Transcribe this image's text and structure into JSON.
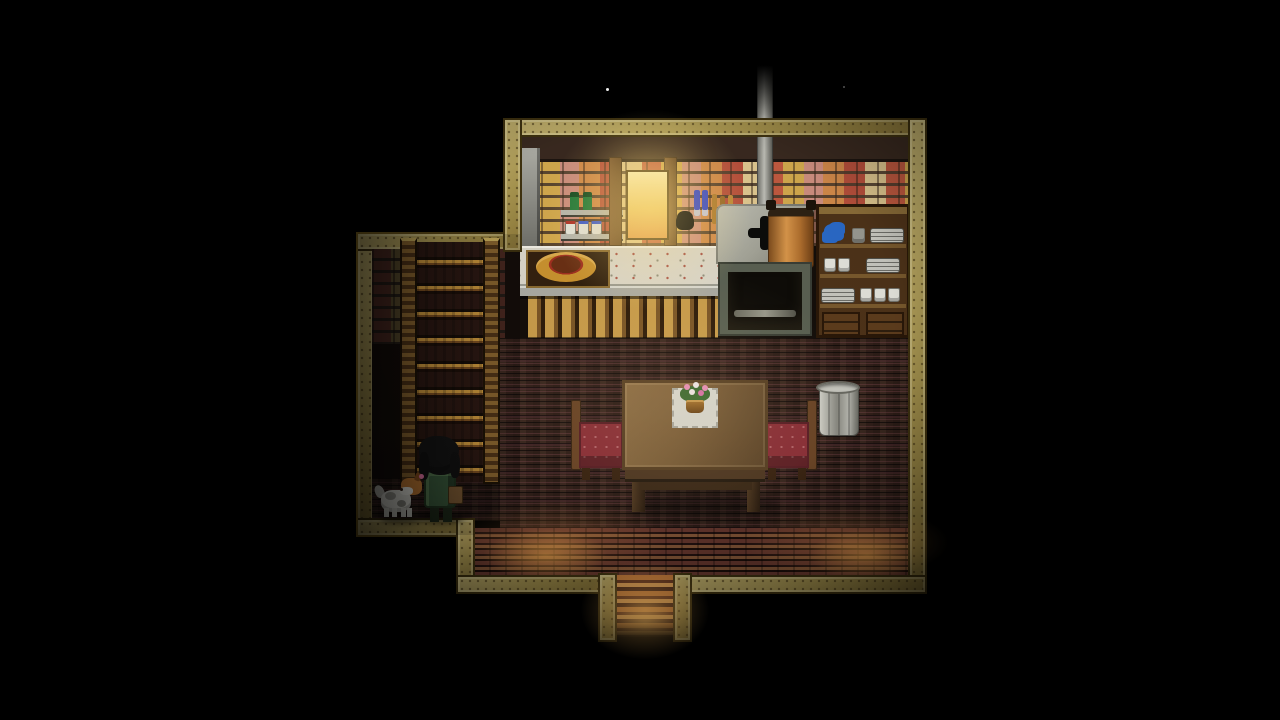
{
  "meta": {
    "app": "pixel-rpg",
    "scene_label": "Top-down pixel-art cottage interior at night",
    "view": "top-down"
  },
  "palette": {
    "frame_light": "#c9b873",
    "frame_mid": "#a8954f",
    "frame_dark": "#403310",
    "wall_band": "#3a2a20",
    "wall_dark_bg": "#140e0a",
    "mortar": "#6e5b47",
    "brick_a": "#c25a40",
    "brick_b": "#d28a4a",
    "brick_c": "#cf8f80",
    "brick_d": "#d4aa4e",
    "brick_e": "#b8503c",
    "brick_f": "#e0c890",
    "counter_top": "#d9d5c9",
    "counter_edge": "#a9a9a1",
    "cabinet_base": "#53361c",
    "cabinet_slat": "#c79b4a",
    "stove_gray": "#a2a296",
    "stove_frame": "#5a6052",
    "hearth": "#0e0c08",
    "copper": "#b06f2e",
    "copper_hi": "#d8964a",
    "chimney": "#c0c0b8",
    "dishcab_wood": "#4e3319",
    "dishcab_shelf": "#7a5a2e",
    "plate_gray": "#b8b8b0",
    "teapot_blue": "#2a6ac8",
    "floor_base": "#32201a",
    "floor_maroon": "#5a3038",
    "bwall_base": "#2e1812",
    "glow_warm": "#ffaa50",
    "glow_window": "#ffd98e",
    "table_top": "#7b5e39",
    "table_edge": "#584024",
    "chair_red": "#8c3038",
    "chair_wood": "#6b4526",
    "metal_light": "#d0d0c8",
    "metal_dark": "#8a8a82",
    "stair_tread": "#2b1812",
    "stair_nose": "#c8943c",
    "rail_light": "#8a652f",
    "rail_dark": "#4e3317",
    "coat_green": "#3a5a3c",
    "hair_black": "#141414",
    "skin": "#d9ae8b",
    "satchel": "#7c5a34",
    "pet_white": "#d9d9d1",
    "pet_gray": "#9a9a92",
    "pet_orange": "#c07a34",
    "shelf_metal": "#b8b8b0",
    "bottle_green": "#1f7a3a",
    "window_warm": "#f2cf6e",
    "night": "#000000"
  },
  "scene": {
    "viewport_label": "Cottage interior at night, seen from above",
    "rooms": {
      "kitchen": {
        "label": "Kitchen wall",
        "items": [
          "brick wall",
          "metal locker",
          "wall shelf with green bottles and jars",
          "glowing window",
          "hanging utensils",
          "counter with bread basket",
          "lower cabinet",
          "wood stove with chimney and copper kettle",
          "dish cabinet with plates and cups"
        ]
      },
      "stair_hall": {
        "label": "Stair hall",
        "items": [
          "wooden staircase to upper floor"
        ]
      },
      "dining": {
        "label": "Dining area",
        "items": [
          "wooden table",
          "flower vase on doily",
          "left cushioned chair",
          "right cushioned chair",
          "metal bin"
        ]
      },
      "entrance": {
        "label": "Front entrance",
        "items": [
          "doorway",
          "glowing doorstep"
        ]
      }
    },
    "character": {
      "label": "Player character",
      "description": "Dark-haired villager in a green coat with a satchel, standing at the foot of the stairs"
    },
    "pet": {
      "label": "Pet dog",
      "description": "Small white-and-orange dog beside the player"
    },
    "lighting": {
      "description": "Dark night vignette; warm light from the kitchen window, front windows and doorstep",
      "stars": "Two faint stars above the roof"
    }
  }
}
